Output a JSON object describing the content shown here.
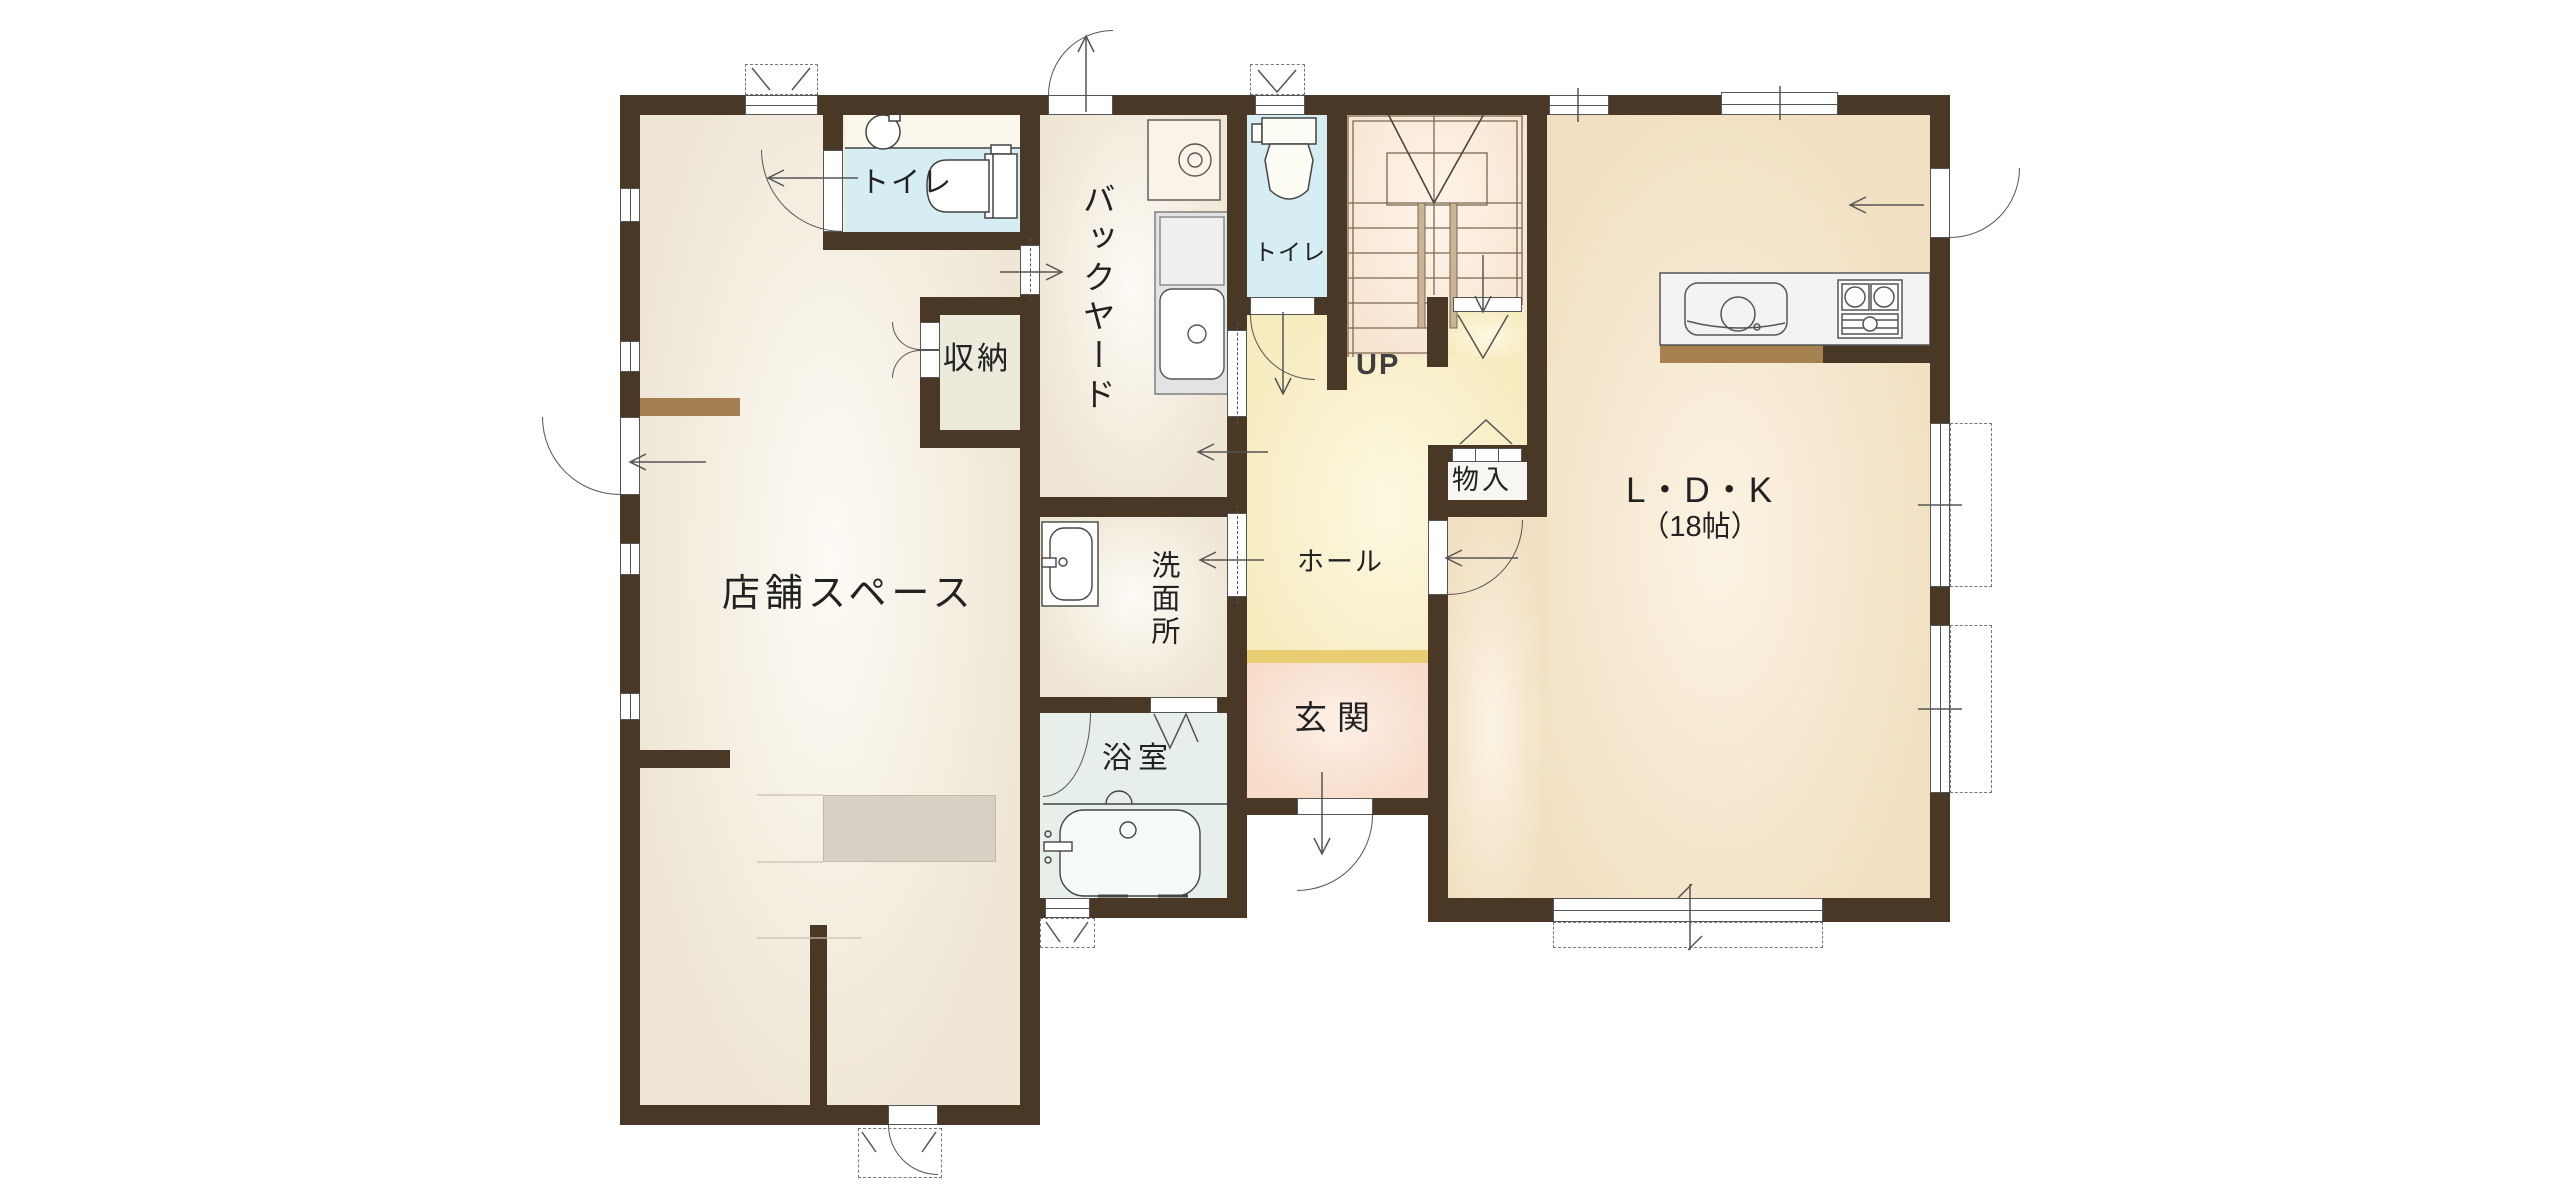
{
  "title": "1F間取り図",
  "rooms": {
    "shop": {
      "label": "店舗スペース"
    },
    "toilet_left": {
      "label": "トイレ"
    },
    "toilet_center": {
      "label": "トイレ"
    },
    "backyard": {
      "label": "バックヤード"
    },
    "storage": {
      "label": "収納"
    },
    "closet": {
      "label": "物入"
    },
    "washroom": {
      "label": "洗面所"
    },
    "hall": {
      "label": "ホール"
    },
    "bathroom": {
      "label": "浴室"
    },
    "entrance": {
      "label": "玄関"
    },
    "ldk": {
      "label": "L・D・K",
      "size": "（18帖）"
    },
    "stairs": {
      "label": "UP"
    }
  },
  "colors": {
    "wall": "#4a3827",
    "floor_beige": "#efe6d5",
    "floor_beige_hi": "#fdfbf5",
    "floor_ldk": "#f1dfc1",
    "floor_ldk_hi": "#fbf3e3",
    "floor_hall": "#f6ecc0",
    "floor_hall_hi": "#fdf8e1",
    "floor_entrance": "#f7dcc9",
    "floor_entrance_hi": "#fdf0e6",
    "floor_toilet": "#d5edf3",
    "floor_toilet_band": "#fbf7ec",
    "floor_bath": "#e6efe9",
    "floor_stairs": "#f8e5d1",
    "floor_stairs_hi": "#fdf4ea",
    "floor_storage": "#eceada",
    "closet_fill": "#f7f6f1",
    "counter_grey": "#d8cfc5",
    "shelf_tan": "#a57e4f",
    "step_gold": "#e8cd72",
    "under_counter_tan": "#a5824f",
    "kitchen_white": "#f3f3f3",
    "stair_rail_tan": "#c9b595",
    "line": "#555555"
  }
}
